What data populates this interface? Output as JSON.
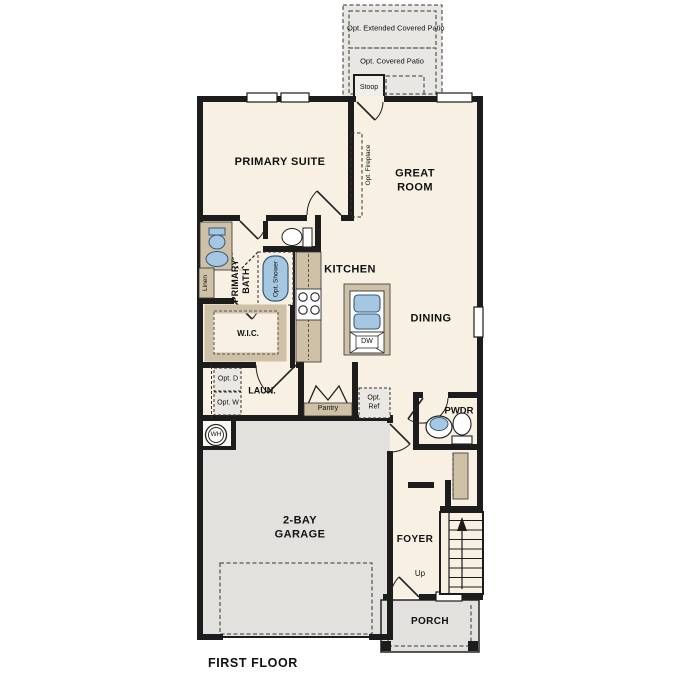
{
  "title": "FIRST FLOOR",
  "colors": {
    "wall": "#1c1c1c",
    "floor": "#f7f0e3",
    "garage_floor": "#e2e1dd",
    "patio_floor": "#e8e7e4",
    "counter": "#cfc1a6",
    "fixture_blue": "#a6c7e2"
  },
  "rooms": {
    "primary_suite": "PRIMARY SUITE",
    "great_room": "GREAT ROOM",
    "kitchen": "KITCHEN",
    "dining": "DINING",
    "primary_bath": "PRIMARY BATH",
    "wic": "W.I.C.",
    "laundry": "LAUN.",
    "pantry": "Pantry",
    "powder": "PWDR",
    "garage": "2-BAY GARAGE",
    "foyer": "FOYER",
    "porch": "PORCH",
    "stoop": "Stoop"
  },
  "options": {
    "extended_patio": "Opt. Extended Covered Patio",
    "covered_patio": "Opt. Covered Patio",
    "fireplace": "Opt. Fireplace",
    "shower": "Opt. Shower",
    "dryer": "Opt. D",
    "washer": "Opt. W",
    "fridge": "Opt. Ref"
  },
  "fixtures": {
    "dishwasher": "DW",
    "water_heater": "WH",
    "stairs_direction": "Up",
    "linen": "Linen"
  }
}
